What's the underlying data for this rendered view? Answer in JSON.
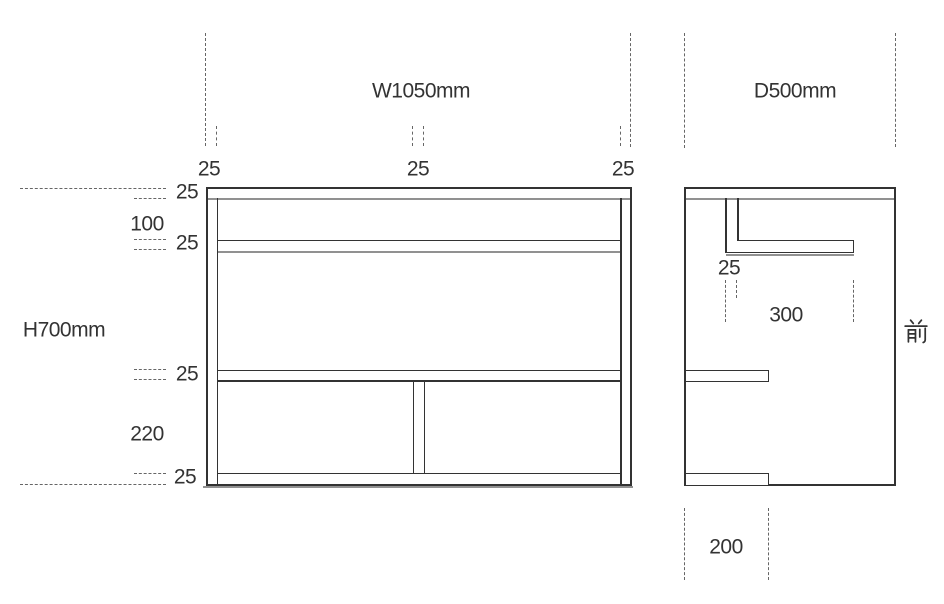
{
  "colors": {
    "line": "#333333",
    "shadow": "#919191",
    "dash": "#666666",
    "text": "#333333",
    "background": "#ffffff"
  },
  "front_view": {
    "width_label": "W1050mm",
    "height_label": "H700mm",
    "left_panel_thickness": "25",
    "center_divider_thickness": "25",
    "right_panel_thickness": "25",
    "top_board_thickness": "25",
    "top_shelf_gap": "100",
    "upper_shelf_thickness": "25",
    "lower_shelf_thickness": "25",
    "bottom_compartment_height": "220",
    "bottom_board_thickness": "25"
  },
  "side_view": {
    "depth_label": "D500mm",
    "bracket_thickness": "25",
    "upper_shelf_depth": "300",
    "bottom_board_depth": "200",
    "front_marker": "前"
  }
}
